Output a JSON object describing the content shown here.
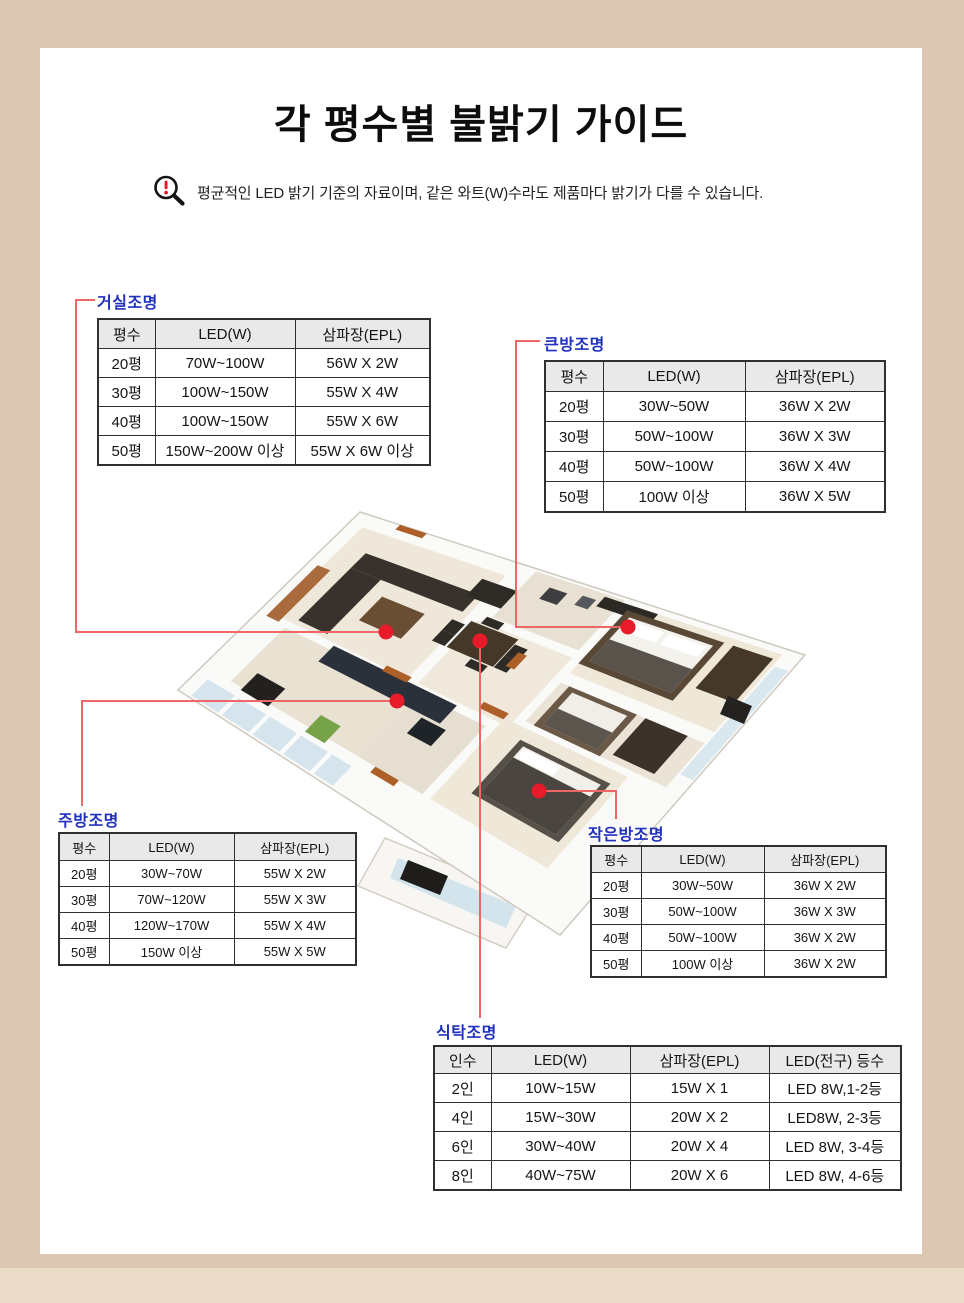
{
  "page": {
    "title": "각 평수별 불밝기 가이드",
    "notice": "평균적인 LED 밝기 기준의 자료이며, 같은 와트(W)수라도 제품마다 밝기가 다를 수 있습니다."
  },
  "colors": {
    "frame": "#dcc7b3",
    "frame_light": "#eadbc9",
    "section_label_blue": "#2130bf",
    "marker_red": "#e71b2a",
    "connector_red": "#ee6666",
    "table_header_bg": "#e9e9e9"
  },
  "floorplan": {
    "alt": "3D isometric apartment floor plan with red marker dots on living room, kitchen, dining table, big bedroom and small bedroom"
  },
  "sections": [
    {
      "id": "living",
      "label": "거실조명",
      "headers": [
        "평수",
        "LED(W)",
        "삼파장(EPL)"
      ],
      "rows": [
        [
          "20평",
          "70W~100W",
          "56W X 2W"
        ],
        [
          "30평",
          "100W~150W",
          "55W X 4W"
        ],
        [
          "40평",
          "100W~150W",
          "55W X 6W"
        ],
        [
          "50평",
          "150W~200W 이상",
          "55W X 6W 이상"
        ]
      ]
    },
    {
      "id": "bigroom",
      "label": "큰방조명",
      "headers": [
        "평수",
        "LED(W)",
        "삼파장(EPL)"
      ],
      "rows": [
        [
          "20평",
          "30W~50W",
          "36W X 2W"
        ],
        [
          "30평",
          "50W~100W",
          "36W X 3W"
        ],
        [
          "40평",
          "50W~100W",
          "36W X 4W"
        ],
        [
          "50평",
          "100W 이상",
          "36W X 5W"
        ]
      ]
    },
    {
      "id": "kitchen",
      "label": "주방조명",
      "headers": [
        "평수",
        "LED(W)",
        "삼파장(EPL)"
      ],
      "rows": [
        [
          "20평",
          "30W~70W",
          "55W X 2W"
        ],
        [
          "30평",
          "70W~120W",
          "55W X 3W"
        ],
        [
          "40평",
          "120W~170W",
          "55W X 4W"
        ],
        [
          "50평",
          "150W 이상",
          "55W X 5W"
        ]
      ]
    },
    {
      "id": "smallroom",
      "label": "작은방조명",
      "headers": [
        "평수",
        "LED(W)",
        "삼파장(EPL)"
      ],
      "rows": [
        [
          "20평",
          "30W~50W",
          "36W X 2W"
        ],
        [
          "30평",
          "50W~100W",
          "36W X 3W"
        ],
        [
          "40평",
          "50W~100W",
          "36W X 2W"
        ],
        [
          "50평",
          "100W 이상",
          "36W X 2W"
        ]
      ]
    },
    {
      "id": "dining",
      "label": "식탁조명",
      "headers": [
        "인수",
        "LED(W)",
        "삼파장(EPL)",
        "LED(전구) 등수"
      ],
      "rows": [
        [
          "2인",
          "10W~15W",
          "15W X 1",
          "LED 8W,1-2등"
        ],
        [
          "4인",
          "15W~30W",
          "20W X 2",
          "LED8W, 2-3등"
        ],
        [
          "6인",
          "30W~40W",
          "20W X 4",
          "LED 8W, 3-4등"
        ],
        [
          "8인",
          "40W~75W",
          "20W X 6",
          "LED 8W, 4-6등"
        ]
      ]
    }
  ]
}
